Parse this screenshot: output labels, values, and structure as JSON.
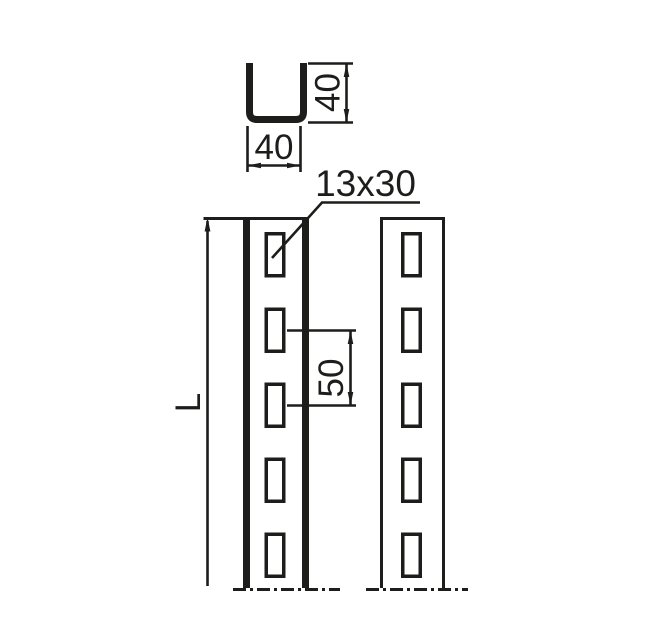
{
  "page": {
    "background_color": "#ffffff",
    "line_color": "#1d1d1b",
    "description": "Technical drawing of slotted U-channel profile"
  },
  "views": {
    "cross_section": {
      "name": "U-channel cross-section",
      "width_label": "40",
      "height_label": "40"
    },
    "front_view": {
      "name": "front view of slotted channel",
      "slot_label": "13x30",
      "pitch_label": "50",
      "length_label": "L",
      "slot_count": 5
    },
    "side_view": {
      "name": "side view of slotted channel",
      "slot_count": 5
    }
  }
}
